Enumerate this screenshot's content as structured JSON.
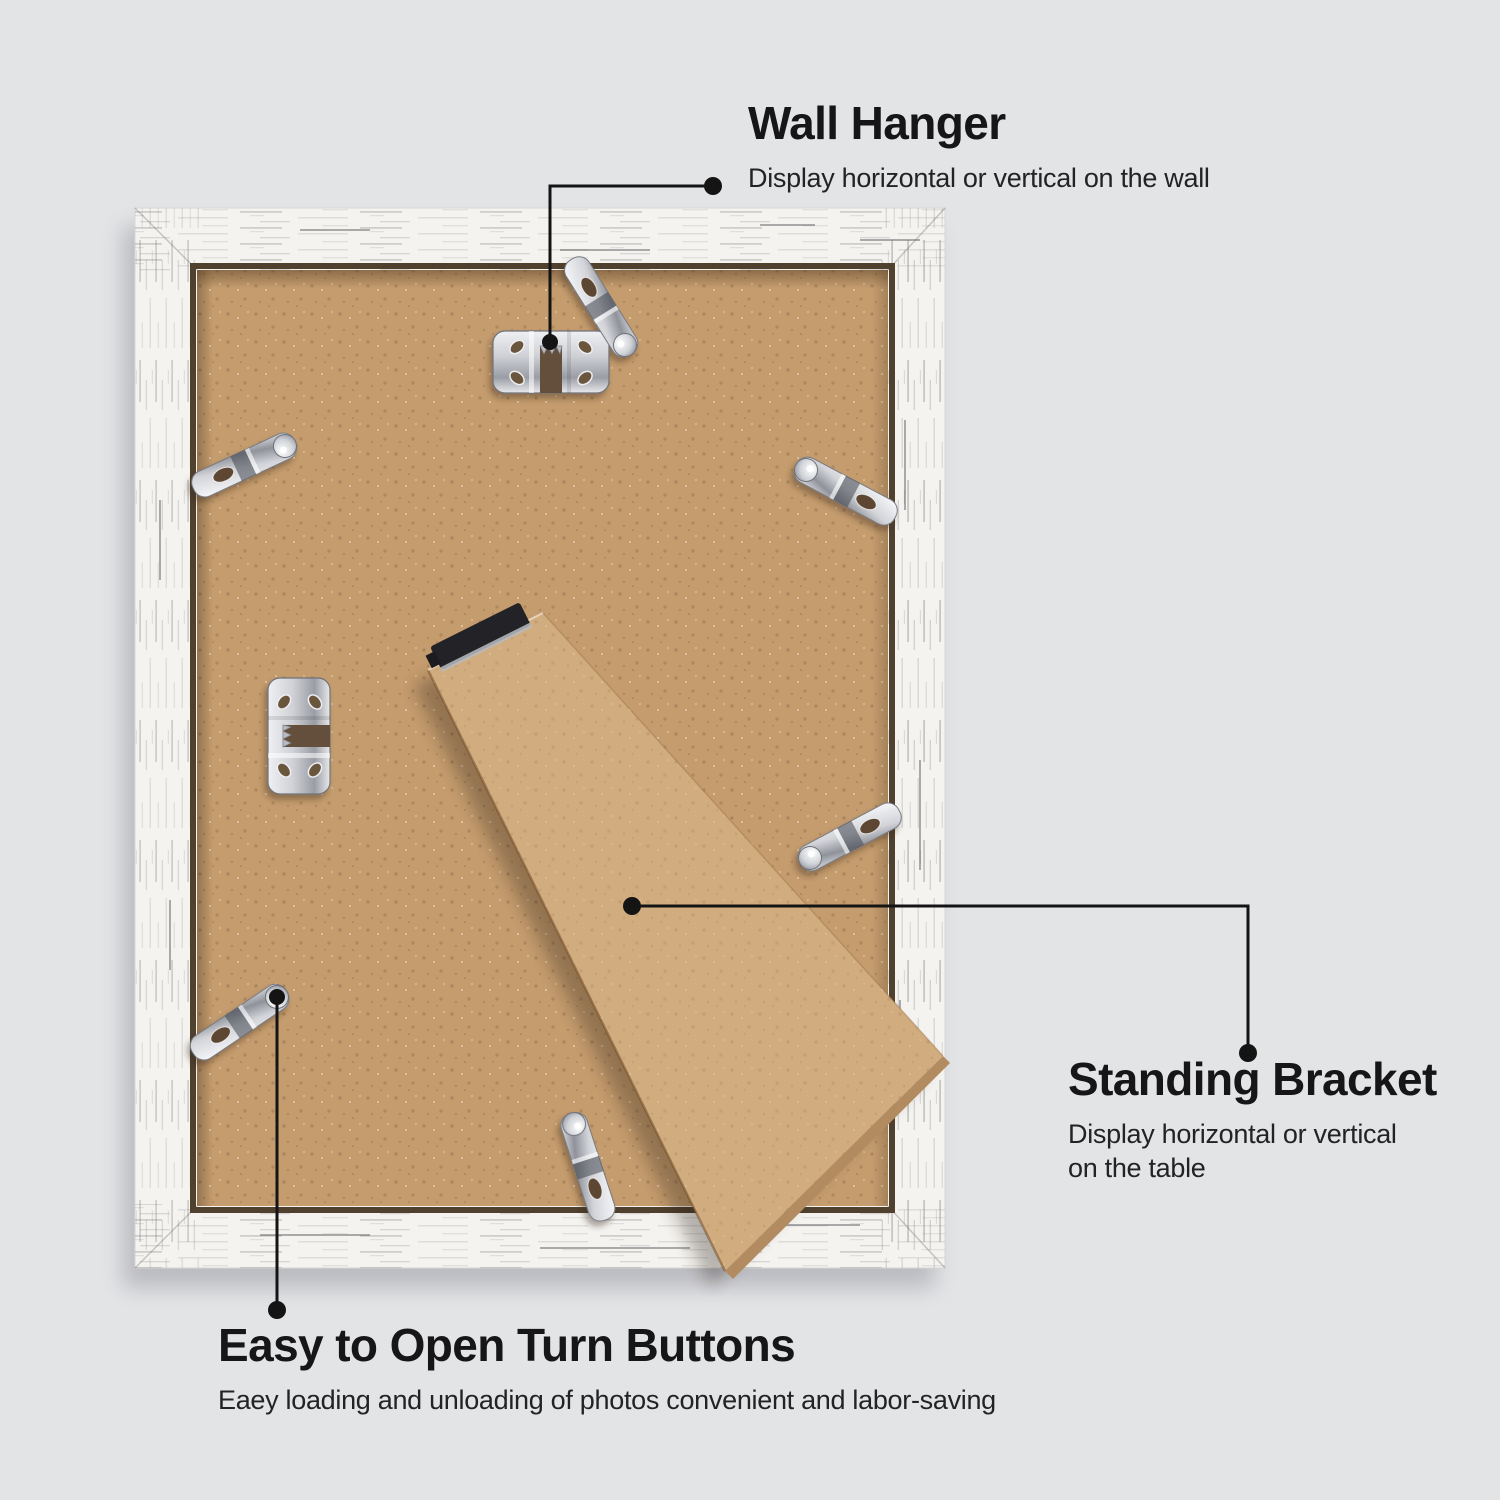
{
  "page": {
    "type": "product-feature-annotation-image",
    "subject": "back view of a distressed white picture frame",
    "background_color": "#e3e4e6",
    "text_color": "#1b1b1d",
    "callout_line_color": "#141414"
  },
  "callouts": {
    "wall_hanger": {
      "title": "Wall Hanger",
      "description": "Display horizontal or vertical on the wall"
    },
    "standing_bracket": {
      "title": "Standing Bracket",
      "description_line1": "Display horizontal or vertical",
      "description_line2": "on the table"
    },
    "turn_buttons": {
      "title": "Easy to Open Turn Buttons",
      "description": "Eaey loading and unloading of photos convenient and labor-saving"
    }
  },
  "scene": {
    "frame": {
      "finish": "distressed white wood",
      "color": "#f4f3f0"
    },
    "backboard": {
      "material": "MDF backing board",
      "color": "#c49c6e"
    },
    "standing_bracket": {
      "material": "MDF easel leg",
      "color": "#d1ac7e"
    },
    "hardware": {
      "metal_color": "#d4d6db",
      "wall_hanger_count": 2,
      "turn_button_count": 6,
      "standing_bracket_count": 1
    }
  }
}
